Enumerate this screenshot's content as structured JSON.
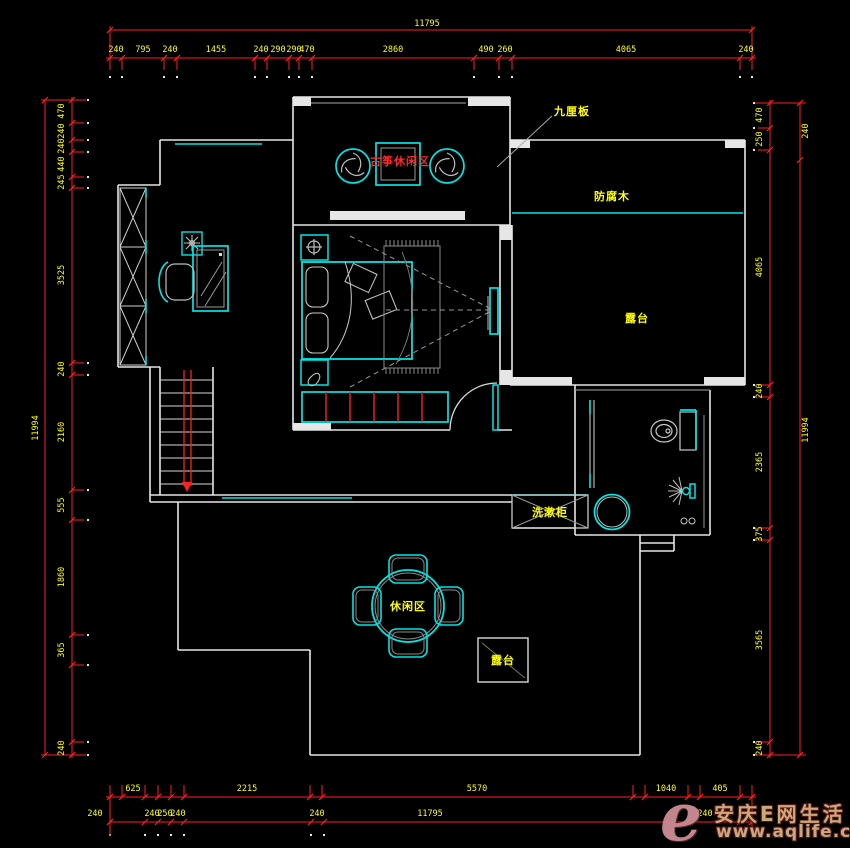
{
  "colors": {
    "background": "#000000",
    "wall": "#e6e6e6",
    "furniture": "#00e5e5",
    "dimension_line": "#ff2020",
    "dimension_text": "#ffff00",
    "room_label_yellow": "#ffff00",
    "room_label_red": "#ff2a2a",
    "watermark_logo": "#c4868e",
    "watermark_text": "#cfa878"
  },
  "room_labels": [
    {
      "id": "guzheng-leisure-area",
      "text": "古筝休闲区",
      "x": 400,
      "y": 161,
      "color": "#ff2a2a"
    },
    {
      "id": "board-annotation",
      "text": "九厘板",
      "x": 572,
      "y": 111,
      "color": "#ffff00"
    },
    {
      "id": "anticorrosive-wood",
      "text": "防腐木",
      "x": 612,
      "y": 196,
      "color": "#ffff00"
    },
    {
      "id": "terrace-right",
      "text": "露台",
      "x": 637,
      "y": 318,
      "color": "#ffff00"
    },
    {
      "id": "washstand-cabinet",
      "text": "洗漱柜",
      "x": 550,
      "y": 512,
      "color": "#ffff00"
    },
    {
      "id": "leisure-area",
      "text": "休闲区",
      "x": 408,
      "y": 606,
      "color": "#ffff00"
    },
    {
      "id": "terrace-bottom",
      "text": "露台",
      "x": 503,
      "y": 660,
      "color": "#ffff00"
    }
  ],
  "dimensions": {
    "top": {
      "overall": {
        "text": "11795",
        "x": 427,
        "label_y": 26,
        "line_y": 30,
        "x1": 110,
        "x2": 752
      },
      "chain_y": 58,
      "label_y": 52,
      "ticks": [
        110,
        122,
        164,
        177,
        255,
        267,
        289,
        299,
        312,
        474,
        499,
        512,
        740,
        752
      ],
      "labels": [
        {
          "text": "240",
          "x": 116
        },
        {
          "text": "795",
          "x": 143
        },
        {
          "text": "240",
          "x": 170
        },
        {
          "text": "1455",
          "x": 216
        },
        {
          "text": "240",
          "x": 261
        },
        {
          "text": "290",
          "x": 278
        },
        {
          "text": "290",
          "x": 294
        },
        {
          "text": "470",
          "x": 307
        },
        {
          "text": "2860",
          "x": 393
        },
        {
          "text": "490",
          "x": 486
        },
        {
          "text": "260",
          "x": 505
        },
        {
          "text": "4065",
          "x": 626
        },
        {
          "text": "240",
          "x": 746
        }
      ]
    },
    "left": {
      "outer": {
        "text": "11994",
        "x": 45,
        "y1": 100,
        "y2": 755,
        "label_x": 38,
        "label_y": 428
      },
      "chain_x": 72,
      "label_x": 64,
      "ticks": [
        100,
        123,
        140,
        152,
        177,
        188,
        363,
        375,
        490,
        520,
        635,
        665,
        742,
        755
      ],
      "labels": [
        {
          "text": "470",
          "y": 111
        },
        {
          "text": "240",
          "y": 131
        },
        {
          "text": "240",
          "y": 146
        },
        {
          "text": "440",
          "y": 164
        },
        {
          "text": "245",
          "y": 182
        },
        {
          "text": "3525",
          "y": 275
        },
        {
          "text": "240",
          "y": 369
        },
        {
          "text": "2160",
          "y": 432
        },
        {
          "text": "555",
          "y": 505
        },
        {
          "text": "1860",
          "y": 577
        },
        {
          "text": "365",
          "y": 650
        },
        {
          "text": "240",
          "y": 748
        }
      ]
    },
    "right": {
      "outer": {
        "x": 800,
        "label_x": 808,
        "y1": 103,
        "y2": 755,
        "ticks": [
          103,
          160,
          755
        ],
        "labels": [
          {
            "text": "240",
            "y": 131
          },
          {
            "text": "11994",
            "y": 430
          }
        ]
      },
      "chain_x": 770,
      "label_x": 762,
      "ticks": [
        103,
        128,
        150,
        385,
        397,
        528,
        540,
        742,
        755
      ],
      "labels": [
        {
          "text": "470",
          "y": 115
        },
        {
          "text": "250",
          "y": 139
        },
        {
          "text": "4065",
          "y": 267
        },
        {
          "text": "240",
          "y": 391
        },
        {
          "text": "2365",
          "y": 462
        },
        {
          "text": "375",
          "y": 534
        },
        {
          "text": "3565",
          "y": 640
        },
        {
          "text": "240",
          "y": 748
        }
      ]
    },
    "bottom": {
      "row1": {
        "y": 797,
        "label_y": 791,
        "ticks": [
          110,
          122,
          145,
          158,
          171,
          184,
          310,
          322,
          633,
          645,
          688,
          700,
          740,
          752
        ],
        "labels": [
          {
            "text": "625",
            "x": 133
          },
          {
            "text": "2215",
            "x": 247
          },
          {
            "text": "5570",
            "x": 477
          },
          {
            "text": "1040",
            "x": 666
          },
          {
            "text": "405",
            "x": 720
          }
        ]
      },
      "row2": {
        "y": 822,
        "label_y": 816,
        "ticks": [
          110,
          145,
          158,
          171,
          184,
          311,
          324,
          740,
          752
        ],
        "labels": [
          {
            "text": "240",
            "x": 95
          },
          {
            "text": "240",
            "x": 152
          },
          {
            "text": "250",
            "x": 165
          },
          {
            "text": "240",
            "x": 178
          },
          {
            "text": "240",
            "x": 317
          },
          {
            "text": "11795",
            "x": 430
          },
          {
            "text": "240",
            "x": 705
          }
        ]
      }
    }
  },
  "watermark": {
    "logo_letter": "e",
    "line1": "安庆E网生活",
    "line2": "www.aqlife.com"
  }
}
